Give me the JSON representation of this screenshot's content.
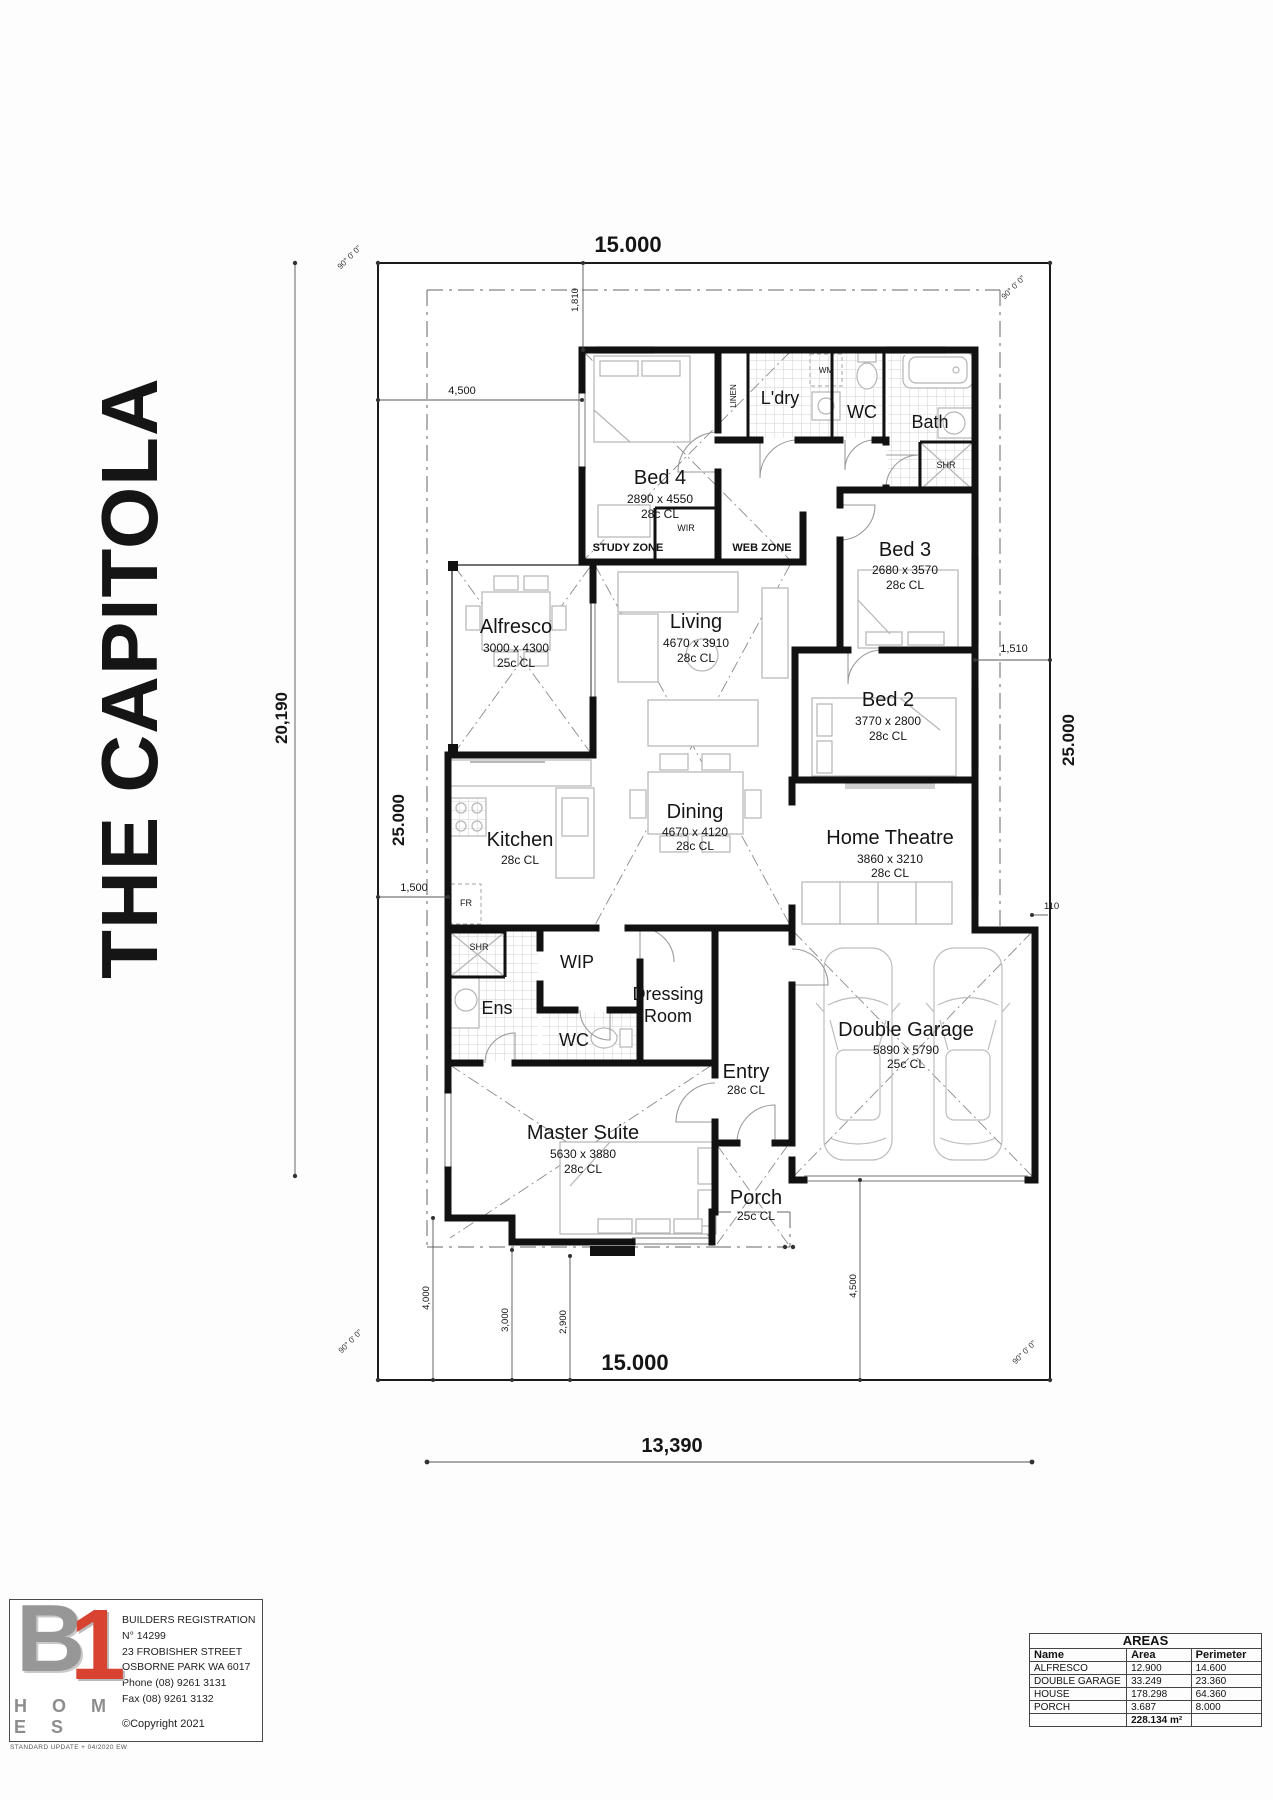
{
  "title": "THE CAPITOLA",
  "dims": {
    "top_width": "15.000",
    "top_offset": "1,810",
    "top_left": "4,500",
    "left_outer": "20,190",
    "left_boundary": "25.000",
    "left_small": "1,500",
    "right_boundary": "25.000",
    "right_small": "1,510",
    "right_tiny": "110",
    "bottom_width": "15.000",
    "bottom_total": "13,390",
    "bottom_d1": "4,000",
    "bottom_d2": "3,000",
    "bottom_d3": "2,900",
    "bottom_d4": "4,500",
    "angle": "90° 0' 0\""
  },
  "rooms": {
    "bed4": {
      "name": "Bed 4",
      "size": "2890 x 4550",
      "ceiling": "28c CL"
    },
    "ldry": {
      "name": "L'dry"
    },
    "wc1": {
      "name": "WC"
    },
    "bath": {
      "name": "Bath"
    },
    "bed3": {
      "name": "Bed 3",
      "size": "2680 x 3570",
      "ceiling": "28c CL"
    },
    "alfresco": {
      "name": "Alfresco",
      "size": "3000 x 4300",
      "ceiling": "25c CL"
    },
    "living": {
      "name": "Living",
      "size": "4670 x 3910",
      "ceiling": "28c CL"
    },
    "bed2": {
      "name": "Bed 2",
      "size": "3770 x 2800",
      "ceiling": "28c CL"
    },
    "kitchen": {
      "name": "Kitchen",
      "ceiling": "28c CL"
    },
    "dining": {
      "name": "Dining",
      "size": "4670 x 4120",
      "ceiling": "28c CL"
    },
    "theatre": {
      "name": "Home Theatre",
      "size": "3860 x 3210",
      "ceiling": "28c CL"
    },
    "wip": {
      "name": "WIP"
    },
    "ens": {
      "name": "Ens"
    },
    "wc2": {
      "name": "WC"
    },
    "dressing": {
      "line1": "Dressing",
      "line2": "Room"
    },
    "entry": {
      "name": "Entry",
      "ceiling": "28c CL"
    },
    "master": {
      "name": "Master Suite",
      "size": "5630 x 3880",
      "ceiling": "28c CL"
    },
    "porch": {
      "name": "Porch",
      "ceiling": "25c CL"
    },
    "garage": {
      "name": "Double Garage",
      "size": "5890 x 5790",
      "ceiling": "25c CL"
    }
  },
  "zones": {
    "study": "STUDY ZONE",
    "web": "WEB ZONE",
    "wir": "WIR",
    "linen": "LINEN",
    "wm": "WM",
    "shr_bath": "SHR",
    "shr_ens": "SHR",
    "fr": "FR"
  },
  "logo": {
    "b": "B",
    "one": "1",
    "homes": "H O M E S",
    "reg1": "BUILDERS REGISTRATION",
    "reg2": "N° 14299",
    "addr1": "23 FROBISHER STREET",
    "addr2": "OSBORNE PARK  WA  6017",
    "phone": "Phone (08) 9261 3131",
    "fax": "Fax (08) 9261 3132",
    "copyright": "©Copyright 2021",
    "footnote": "STANDARD UPDATE + 04/2020 EW"
  },
  "areas": {
    "title": "AREAS",
    "col_name": "Name",
    "col_area": "Area",
    "col_perimeter": "Perimeter",
    "rows": [
      {
        "name": "ALFRESCO",
        "area": "12.900",
        "perimeter": "14.600"
      },
      {
        "name": "DOUBLE GARAGE",
        "area": "33.249",
        "perimeter": "23.360"
      },
      {
        "name": "HOUSE",
        "area": "178.298",
        "perimeter": "64.360"
      },
      {
        "name": "PORCH",
        "area": "3.687",
        "perimeter": "8.000"
      }
    ],
    "total": "228.134 m²"
  }
}
